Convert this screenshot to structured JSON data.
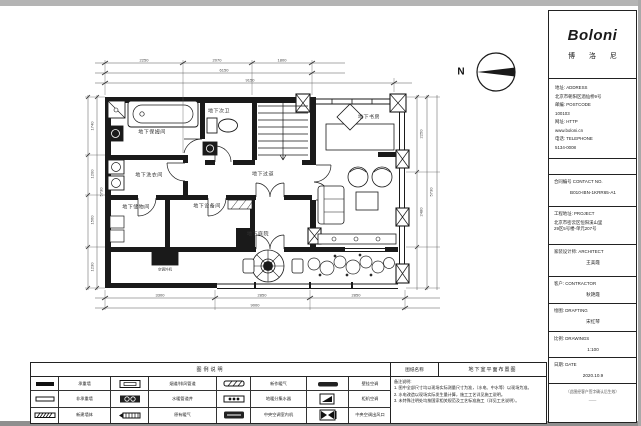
{
  "colors": {
    "line": "#1a1a1a",
    "sheet": "#ffffff"
  },
  "title_block": {
    "logo": "Boloni",
    "logo_sub": "博 洛 尼",
    "address_lines": [
      "地址: ADDRESS",
      "北京市朝阳区酒仙桥9号",
      "邮编: POSTCODE",
      "100103",
      "网址: HTTP",
      "www.boloni.cn",
      "电话: TELEPHONE",
      "5134-0008"
    ],
    "contract": {
      "label": "合同编号 CONTACT NO.",
      "value": "B010-IBN-1KRR65-A1"
    },
    "project": {
      "label": "工程地址: PROJECT",
      "line1": "北京市密云区恒阳溪山里",
      "line2": "29区5号楼-单元207号"
    },
    "architect": {
      "label": "家装设计师: ARCHITECT",
      "value": "王美霞"
    },
    "contractor": {
      "label": "客户: CONTRACTOR",
      "value": "秋艳霞"
    },
    "drafting": {
      "label": "绘图: DRAFTING",
      "value": "宋红琴"
    },
    "scale": {
      "label": "比例: DRAWINGS",
      "value": "1:100"
    },
    "date": {
      "label": "日期: DATE",
      "value": "2020.10.9"
    },
    "stamp_note1": "（此图经客户签字确认后生效）",
    "stamp_note2": "——"
  },
  "plan": {
    "north_label": "N",
    "rooms": {
      "bath": "地下保姆间",
      "wc": "地下次卫",
      "laundry": "地下洗衣间",
      "corridor": "地下过道",
      "storage": "地下储物间",
      "equipment": "地下设备间",
      "study": "地下书房",
      "courtyard": "地下庭院",
      "ac_unit": "空调外机"
    },
    "dims": {
      "top": [
        "2250",
        "2070",
        "1800"
      ],
      "top_mid": "6150",
      "top_total": "9150",
      "left": [
        "1740",
        "1200",
        "1560",
        "1230"
      ],
      "left_total": "5730",
      "right": [
        "2250",
        "2480"
      ],
      "right_total": "5730",
      "bottom": [
        "3300",
        "2850",
        "2850"
      ],
      "bottom_total": "9000"
    }
  },
  "legend": {
    "header": "图例说明",
    "rows": [
      [
        {
          "sym": "load-bearing-wall",
          "label": "承重墙"
        },
        {
          "sym": "flue-duct",
          "label": "烟道/排风管道"
        },
        {
          "sym": "new-radiator",
          "label": "新作暖气"
        },
        {
          "sym": "wall-ac",
          "label": "壁挂空调"
        }
      ],
      [
        {
          "sym": "non-bearing-wall",
          "label": "非承重墙"
        },
        {
          "sym": "pipe-shaft",
          "label": "水暖管道井"
        },
        {
          "sym": "floor-heating-manifold",
          "label": "地暖分集水器"
        },
        {
          "sym": "cabinet-ac",
          "label": "柜机空调"
        }
      ],
      [
        {
          "sym": "new-built-wall",
          "label": "新建墙体"
        },
        {
          "sym": "existing-radiator",
          "label": "原有暖气"
        },
        {
          "sym": "central-ac-indoor-unit",
          "label": "中央空调室内机"
        },
        {
          "sym": "central-ac-outlet",
          "label": "中央空调出风口"
        }
      ]
    ]
  },
  "drawing_name": {
    "label": "图纸名称",
    "value": "地下室平面布置图"
  },
  "notes": {
    "header": "备注说明:",
    "items": [
      "1. 图中全部尺寸均以现场实际测量尺寸为准，（水电、中水等）以现场为准。",
      "2. 水电改造以现场实际发生量计算，施工工艺详见施工说明。",
      "3. 未特殊注明处均按国家相关规范及工艺标准施工（详见工艺说明）。"
    ]
  }
}
